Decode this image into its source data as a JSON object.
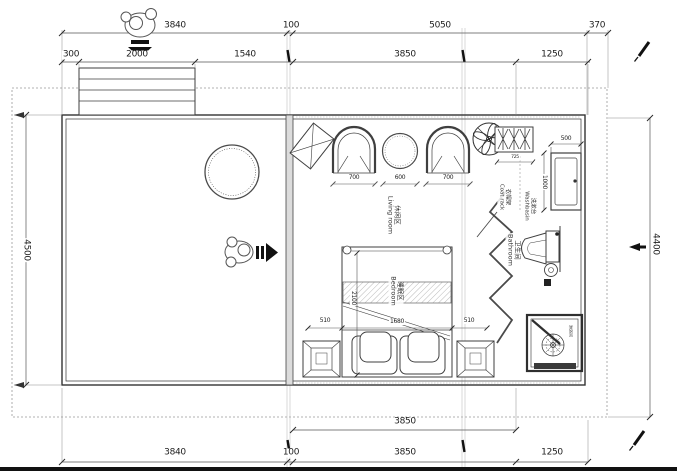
{
  "drawing": {
    "type": "floor-plan",
    "units": "mm"
  },
  "dims_top_outer": [
    "3840",
    "100",
    "5050",
    "370"
  ],
  "dims_top_inner": [
    "300",
    "2000",
    "1540",
    "3850",
    "1250"
  ],
  "dim_left": "4500",
  "dim_right": "4400",
  "dims_bottom_inner": [
    "3850"
  ],
  "dims_bottom_outer": [
    "3840",
    "100",
    "3850",
    "1250"
  ],
  "rooms": {
    "living": {
      "zh": "休闲区",
      "en": "Living room"
    },
    "bedroom": {
      "zh": "睡眠区",
      "en": "Bedroom"
    },
    "bathroom": {
      "zh": "卫生间",
      "en": "Bathroom"
    },
    "washbasin": {
      "zh": "洗漱台",
      "en": "Washbasin"
    },
    "coatrack": {
      "zh": "衣帽架",
      "en": "Coat rack"
    },
    "shower": {
      "zh": "淋浴间"
    }
  },
  "furniture_dims": {
    "chair_left": "700",
    "table": "600",
    "chair_right": "700",
    "coatrack_w": "725",
    "washbasin_w": "500",
    "washbasin_d": "1000",
    "bed_side_left": "510",
    "bed_w": "1680",
    "bed_side_right": "510",
    "bed_l": "2100"
  },
  "icons": {
    "person": "person-top-view",
    "entry_down": "down-arrow",
    "entry_right": "right-arrow",
    "fan": "ceiling-fan",
    "pen": "pen-mark"
  },
  "colors": {
    "line": "#3f3f3f",
    "light_line": "#8a8a8a",
    "wall_fill": "#dcdcdc",
    "black": "#111111"
  }
}
